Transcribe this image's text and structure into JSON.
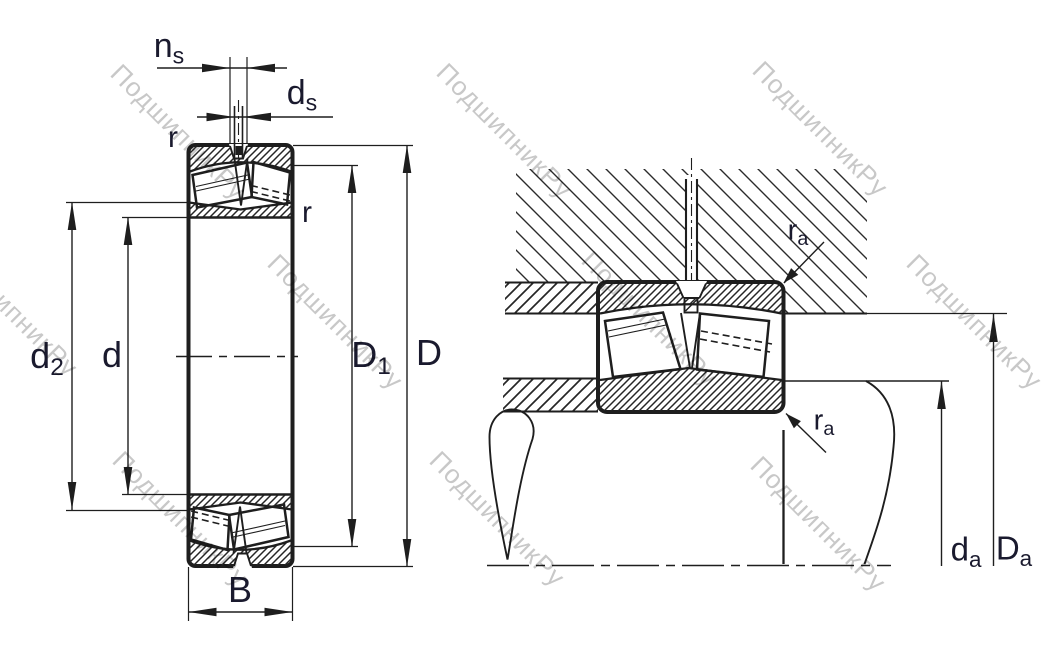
{
  "watermark": {
    "text": "ПодшипникРу",
    "color": "#c8c8c8"
  },
  "colors": {
    "line": "#1e1e1e",
    "label": "#1a1a2e"
  },
  "labels": {
    "ns": {
      "main": "n",
      "sub": "s"
    },
    "ds": {
      "main": "d",
      "sub": "s"
    },
    "r_outer": {
      "text": "r"
    },
    "r_inner": {
      "text": "r"
    },
    "d2": {
      "main": "d",
      "sub": "2"
    },
    "d": {
      "text": "d"
    },
    "D1": {
      "main": "D",
      "sub": "1"
    },
    "D": {
      "text": "D"
    },
    "B": {
      "text": "B"
    },
    "ra_top": {
      "main": "r",
      "sub": "a"
    },
    "ra_bottom": {
      "main": "r",
      "sub": "a"
    },
    "da": {
      "main": "d",
      "sub": "a"
    },
    "Da": {
      "main": "D",
      "sub": "a"
    }
  }
}
